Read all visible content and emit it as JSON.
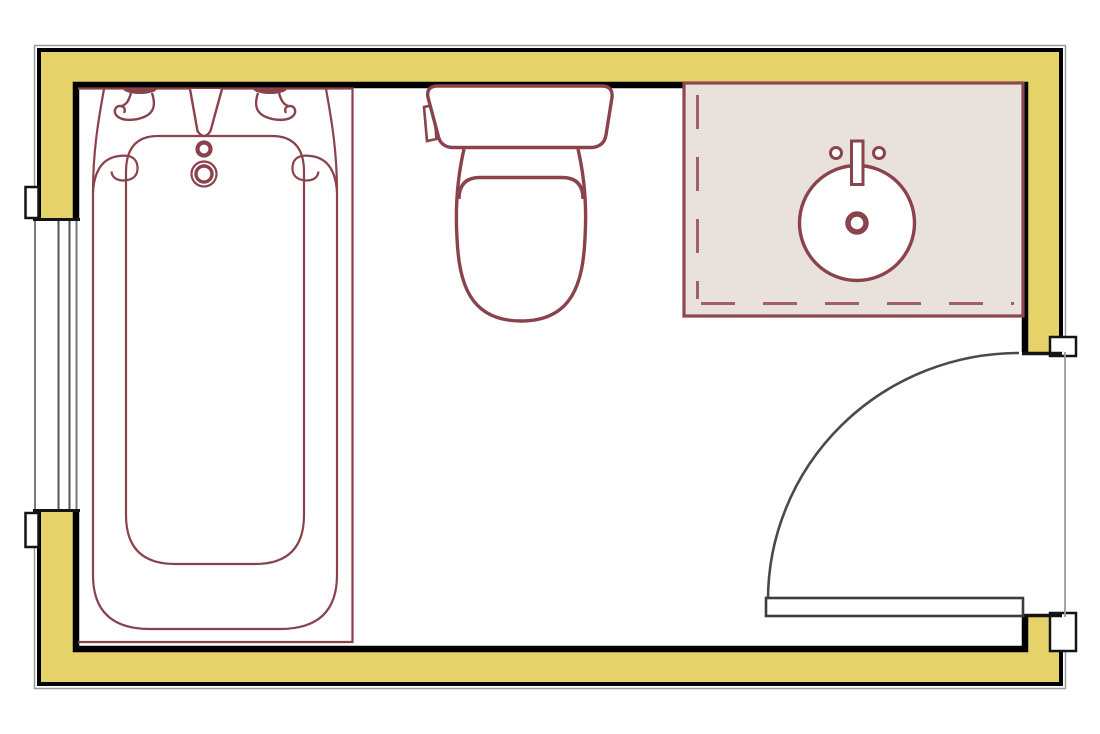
{
  "canvas": {
    "width": 1100,
    "height": 734
  },
  "drawing": {
    "kind": "bathroom-floor-plan",
    "elements": [
      "exterior-walls",
      "window",
      "entry-door",
      "bathtub",
      "toilet",
      "vanity-counter",
      "sink"
    ]
  },
  "colors": {
    "background": "#ffffff",
    "wall_fill": "#e5d269",
    "wall_stroke": "#000000",
    "wall_hairline": "#9b9b9b",
    "fixture_stroke": "#8a434c",
    "fixture_fill": "#ffffff",
    "vanity_fill": "#e9e2dc",
    "vanity_stroke": "#8d4750",
    "vanity_dash": "#a06065",
    "door_stroke": "#4a4a4a",
    "leaf_stroke": "#3d3d3d",
    "jamb_stroke": "#141414",
    "window_pane": "#565656",
    "window_face": "#7a7a7a"
  }
}
